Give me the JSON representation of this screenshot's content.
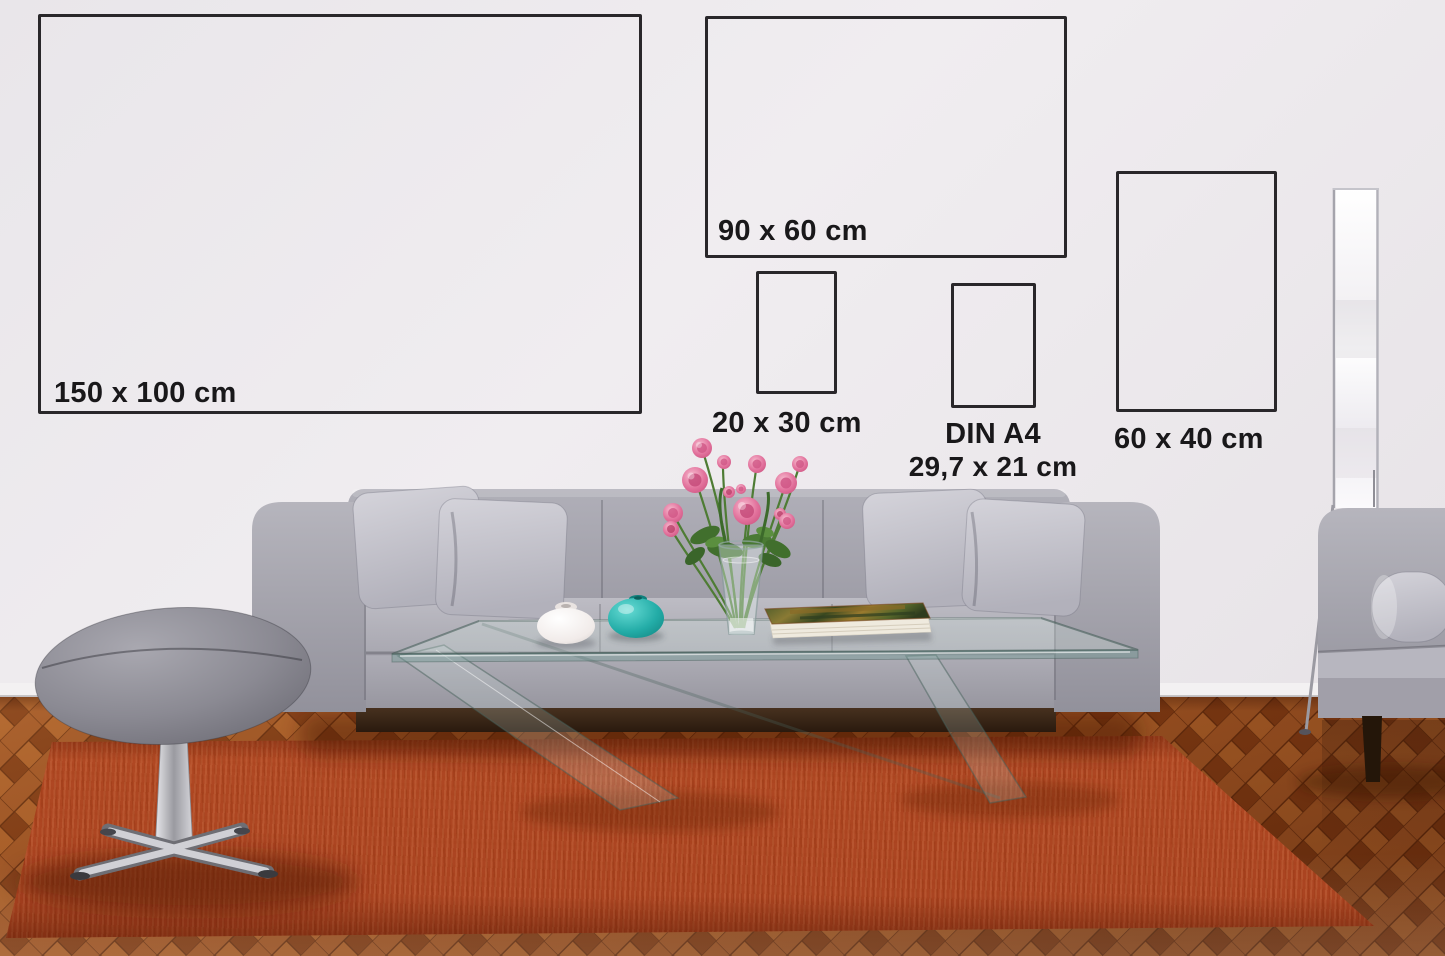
{
  "size_markers": [
    {
      "id": "150x100",
      "label": "150 x 100 cm"
    },
    {
      "id": "90x60",
      "label": "90 x 60 cm"
    },
    {
      "id": "20x30",
      "label": "20 x 30 cm"
    },
    {
      "id": "din-a4",
      "label": "DIN A4",
      "sublabel": "29,7 x 21 cm"
    },
    {
      "id": "60x40",
      "label": "60 x 40 cm"
    }
  ],
  "colors": {
    "wall": "#eae8eb",
    "frame_border": "#29272a",
    "label_text": "#19181a",
    "rug": "#bc4f25",
    "wood_floor": "#8f4c20",
    "sofa": "#a9a8b1",
    "pillows": "#cdccd4",
    "teal_vase": "#1fa9a4",
    "white_vase": "#f3efec",
    "flowers_pink": "#e0709a",
    "stool": "#8e8d96",
    "chrome": "#c6c6cb",
    "lamp": "#fbfafc",
    "book_pages": "#efeade"
  }
}
